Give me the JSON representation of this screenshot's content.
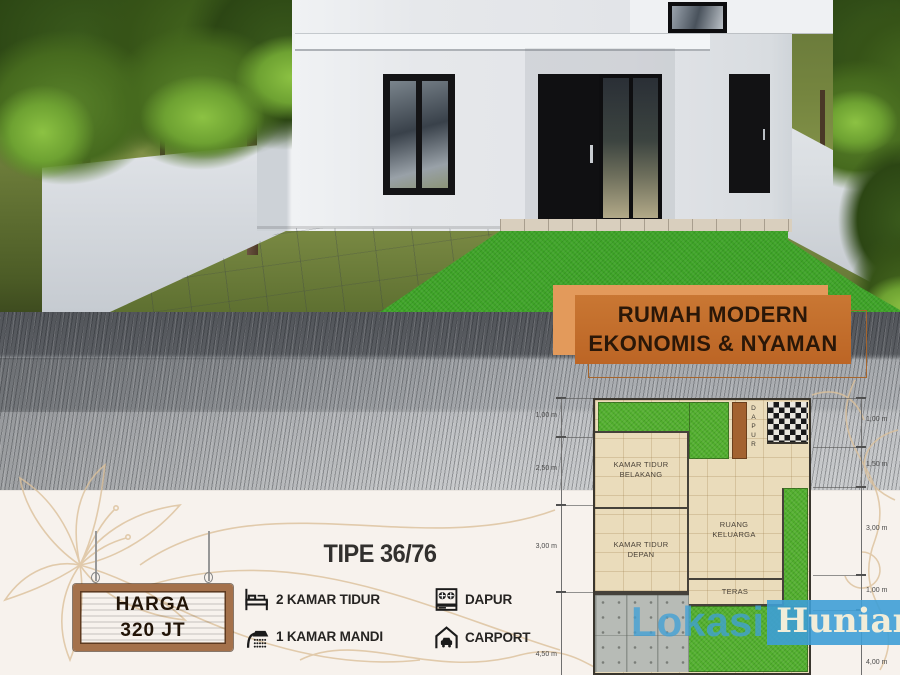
{
  "banner": {
    "line1": "RUMAH MODERN",
    "line2": "EKONOMIS & NYAMAN"
  },
  "price_sign": {
    "label": "HARGA",
    "value": "320 JT"
  },
  "spec": {
    "title": "TIPE 36/76"
  },
  "features": [
    {
      "icon": "bed-icon",
      "label": "2 KAMAR TIDUR"
    },
    {
      "icon": "shower-icon",
      "label": "1 KAMAR MANDI"
    },
    {
      "icon": "stove-icon",
      "label": "DAPUR"
    },
    {
      "icon": "carport-icon",
      "label": "CARPORT"
    }
  ],
  "floor_plan": {
    "rooms": {
      "dapur": "DAPUR",
      "kamar_tidur_belakang": "KAMAR TIDUR BELAKANG",
      "kamar_tidur_depan": "KAMAR TIDUR DEPAN",
      "ruang_keluarga": "RUANG KELUARGA",
      "teras": "TERAS"
    },
    "dims_left": [
      "1,00 m",
      "2,50 m",
      "3,00 m",
      "4,50 m"
    ],
    "dims_right": [
      "1,00 m",
      "1,50 m",
      "3,00 m",
      "1,00 m",
      "4,00 m"
    ]
  },
  "logo": {
    "part1": "Lokasi",
    "part2": "Hunian"
  },
  "colors": {
    "banner_front": "#C2702E",
    "banner_back": "#E39A5B",
    "banner_text": "#2A1708",
    "logo_blue": "#3E9FD6",
    "logo_cream": "#F1EDD9",
    "sign_wood": "#7D5434",
    "sign_frame": "#A4714B",
    "plan_floor": "#EADCBB",
    "plan_grass": "#52AF2E",
    "plan_carport": "#B7BBB6",
    "lawn_green": "#3FA428",
    "house_wall": "#E4E6E9"
  }
}
